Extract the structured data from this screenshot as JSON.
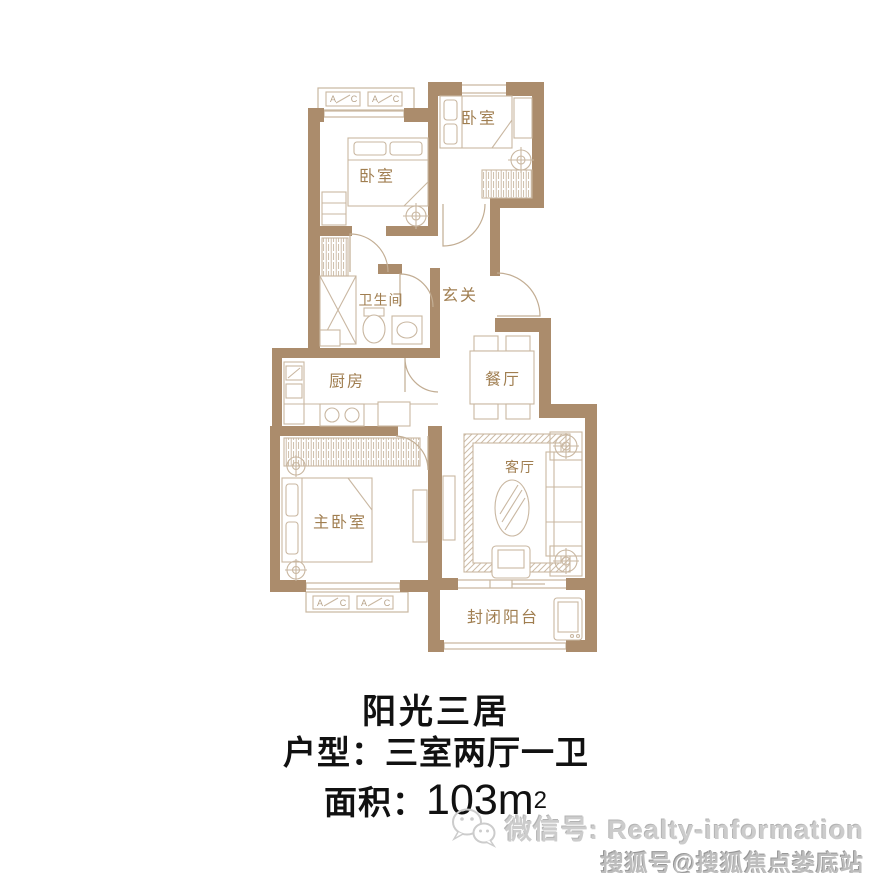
{
  "floor_plan": {
    "rooms": [
      {
        "id": "bedroom-left",
        "label": "卧室"
      },
      {
        "id": "bedroom-right",
        "label": "卧室"
      },
      {
        "id": "bathroom",
        "label": "卫生间"
      },
      {
        "id": "entry-hall",
        "label": "玄关"
      },
      {
        "id": "kitchen",
        "label": "厨房"
      },
      {
        "id": "dining-room",
        "label": "餐厅"
      },
      {
        "id": "living-room",
        "label": "客厅"
      },
      {
        "id": "master-bedroom",
        "label": "主卧室"
      },
      {
        "id": "balcony",
        "label": "封闭阳台"
      }
    ],
    "ac_unit": {
      "a": "A",
      "c": "C"
    },
    "colors": {
      "wall": "#ab8c6c",
      "furniture_line": "#c9b7a1",
      "room_label": "#a07e50",
      "caption_text": "#111111",
      "watermark_gray": "#c6c6c6"
    }
  },
  "caption": {
    "title": "阳光三居",
    "layout_line": "户型：三室两厅一卫",
    "area_prefix": "面积：",
    "area_value": "103m",
    "area_superscript": "2"
  },
  "watermark": {
    "wechat_line": "微信号: Realty-information",
    "sohu_line": "搜狐号@搜狐焦点娄底站"
  }
}
